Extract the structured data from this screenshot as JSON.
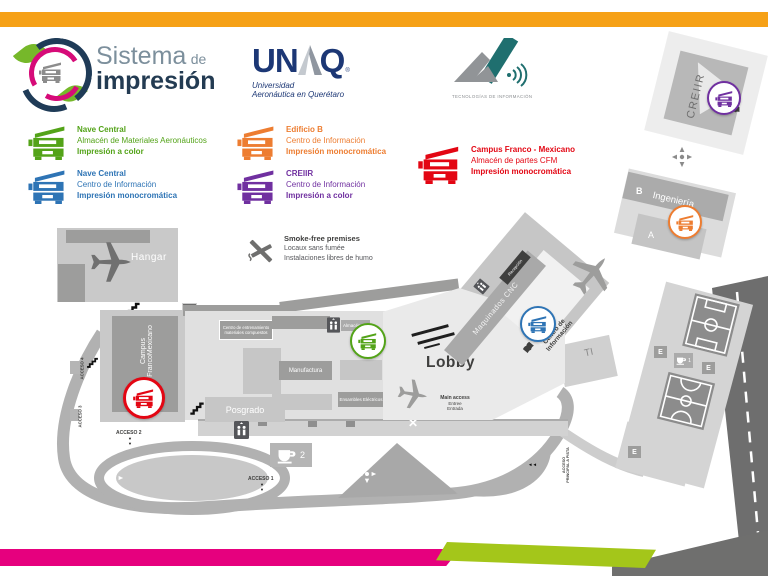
{
  "palette": {
    "accent_yellow": "#F6A117",
    "footer_magenta": "#E6007E",
    "footer_green": "#A4C61A",
    "footer_gray": "#6F6F6E",
    "legend_green": "#53A318",
    "legend_blue": "#2E74B5",
    "legend_orange": "#ED7D31",
    "legend_purple": "#7030A0",
    "legend_red": "#E30613",
    "map_gray": "#C9C9C9",
    "map_dark_gray": "#9D9D9C",
    "road_gray": "#B1B1B1",
    "dark_road": "#6E6E6E"
  },
  "logos": {
    "sistema": {
      "word1": "Sistema",
      "word2": "de",
      "word3": "impresión"
    },
    "unaq": {
      "left": "UN",
      "right": "Q",
      "registered": "®",
      "tagline1": "Universidad",
      "tagline2": "Aeronáutica en Querétaro"
    },
    "ti": {
      "caption": "TECNOLOGÍAS DE INFORMACIÓN"
    }
  },
  "legend": {
    "items": [
      {
        "color": "#53A318",
        "title": "Nave Central",
        "location": "Almacén de Materiales Aeronáuticos",
        "mode": "Impresión a color"
      },
      {
        "color": "#2E74B5",
        "title": "Nave Central",
        "location": "Centro de Información",
        "mode": "Impresión monocromática"
      },
      {
        "color": "#ED7D31",
        "title": "Edificio B",
        "location": "Centro de Información",
        "mode": "Impresión monocromática"
      },
      {
        "color": "#7030A0",
        "title": "CREIIR",
        "location": "Centro de Información",
        "mode": "Impresión a color"
      },
      {
        "color": "#E30613",
        "title": "Campus Franco - Mexicano",
        "location": "Almacén de partes CFM",
        "mode": "Impresión monocromática"
      }
    ]
  },
  "smoke_free": {
    "en": "Smoke-free premises",
    "fr": "Locaux sans fumée",
    "es": "Instalaciones libres de humo"
  },
  "map": {
    "labels": {
      "hangar": "Hangar",
      "campus1": "Campus",
      "campus2": "FrancoMexicano",
      "centro_ent1": "Centro de entrenamiento",
      "centro_ent2": "materiales compuestos",
      "almacen": "Almacén",
      "manufactura": "Manufactura",
      "ensambles": "Ensambles Eléctricos",
      "posgrado": "Posgrado",
      "lobby": "Lobby",
      "maquinados": "Maquinados CNC",
      "recepcion": "Recepción",
      "centro_info1": "Centro de",
      "centro_info2": "Información",
      "ti": "TI",
      "creiir": "CREIIR",
      "b": "B",
      "ingenieria": "Ingeniería",
      "a": "A",
      "e": "E",
      "main_access": "Main access",
      "entree": "Entree",
      "entrada": "Entrada",
      "acceso1": "ACCESO 1",
      "acceso2": "ACCESO 2",
      "acceso3": "ACCESO 3",
      "acceso4": "ACCESO 4",
      "acceso_p1": "ACCESO",
      "acceso_p2": "PRINCIPAL A PISTA",
      "cafe1": "1",
      "cafe2": "2"
    },
    "symbols": {
      "arrow_down": "▼",
      "arrow_left": "◄◄",
      "x_mark": "✕"
    }
  }
}
